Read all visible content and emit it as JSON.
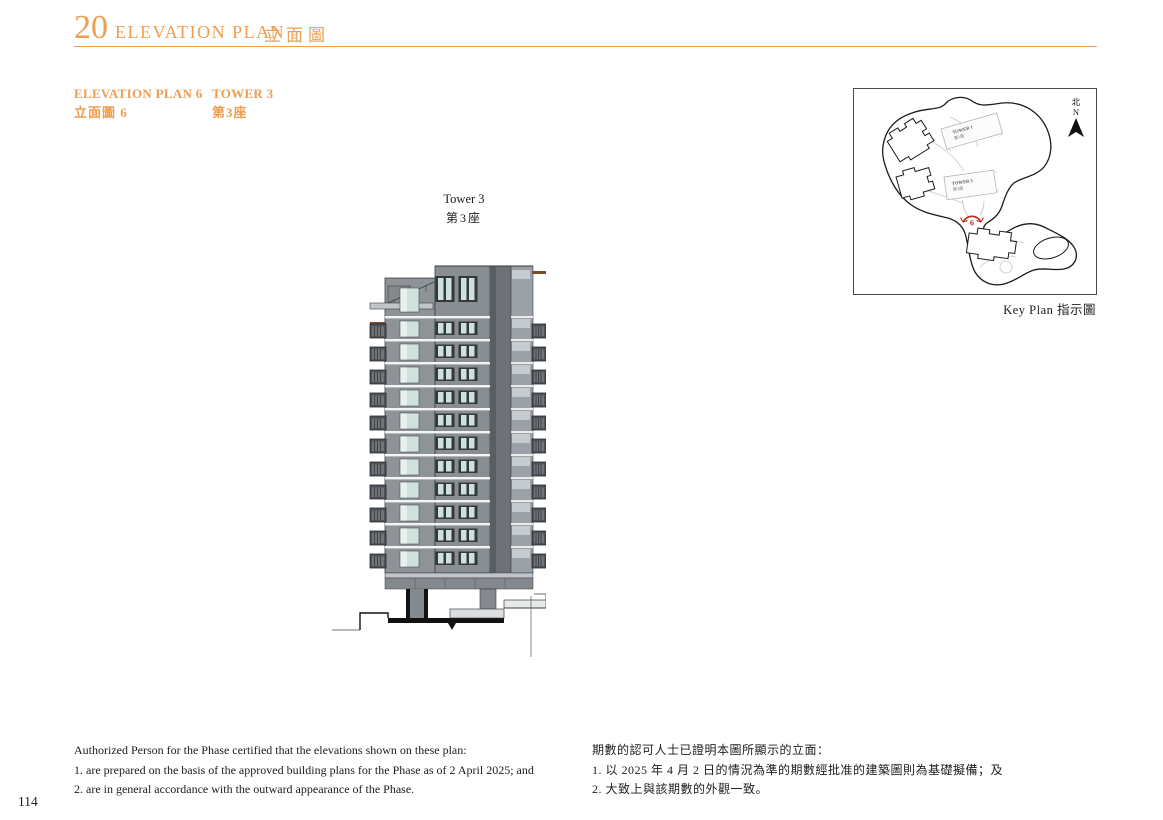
{
  "page": {
    "number": "114"
  },
  "colors": {
    "accent_orange": "#EE9D51",
    "marker_red": "#C8271B",
    "facade_gray": "#8E9398",
    "glass_teal": "#CFE1DC"
  },
  "header": {
    "section_number": "20",
    "title_en": "ELEVATION PLAN",
    "title_zh": "立面圖"
  },
  "subheader": {
    "plan_label_en": "ELEVATION PLAN 6",
    "plan_label_zh": "立面圖 6",
    "tower_label_en": "TOWER 3",
    "tower_label_zh": "第3座"
  },
  "elevation": {
    "tower_caption_en": "Tower 3",
    "tower_caption_zh": "第3座"
  },
  "key_plan": {
    "caption": "Key Plan 指示圖",
    "compass_zh": "北",
    "compass_en": "N",
    "marker_number": "6",
    "tower_labels": [
      {
        "en": "TOWER 1",
        "zh": "第1座"
      },
      {
        "en": "TOWER 3",
        "zh": "第3座"
      }
    ]
  },
  "notes": {
    "en": {
      "intro": "Authorized Person for the Phase certified that the elevations shown on these plan:",
      "items": [
        "1.  are prepared on the basis of the approved building plans for the Phase as of 2 April 2025; and",
        "2.  are in general accordance with the outward appearance of the Phase."
      ]
    },
    "zh": {
      "intro": "期數的認可人士已證明本圖所顯示的立面：",
      "items": [
        "1.  以 2025 年 4 月 2 日的情況為準的期數經批准的建築圖則為基礎擬備；及",
        "2.  大致上與該期數的外觀一致。"
      ]
    }
  }
}
